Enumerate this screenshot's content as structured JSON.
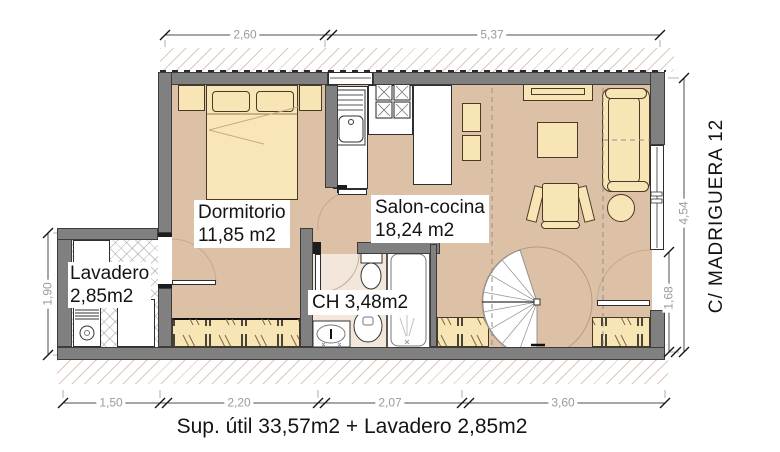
{
  "rooms": {
    "dormitorio": {
      "name": "Dormitorio",
      "area": "11,85 m2"
    },
    "salon_cocina": {
      "name": "Salon-cocina",
      "area": "18,24 m2"
    },
    "lavadero": {
      "name": "Lavadero",
      "area": "2,85m2"
    },
    "bathroom": {
      "name": "CH 3,48m2"
    }
  },
  "street_label": "C/ MADRIGUERA 12",
  "caption": "Sup. útil 33,57m2 + Lavadero 2,85m2",
  "dimensions": {
    "top": [
      "2,60",
      "5,37"
    ],
    "bottom": [
      "1,50",
      "2,20",
      "2,07",
      "3,60"
    ],
    "left": [
      "1,90"
    ],
    "right": [
      "4,54",
      "1,68"
    ]
  },
  "colors": {
    "floor": "#dcc1a7",
    "bath_floor": "#f3e7dc",
    "furniture": "#f8e5b6",
    "wall": "#808080",
    "hatch_line": "#c69884"
  }
}
